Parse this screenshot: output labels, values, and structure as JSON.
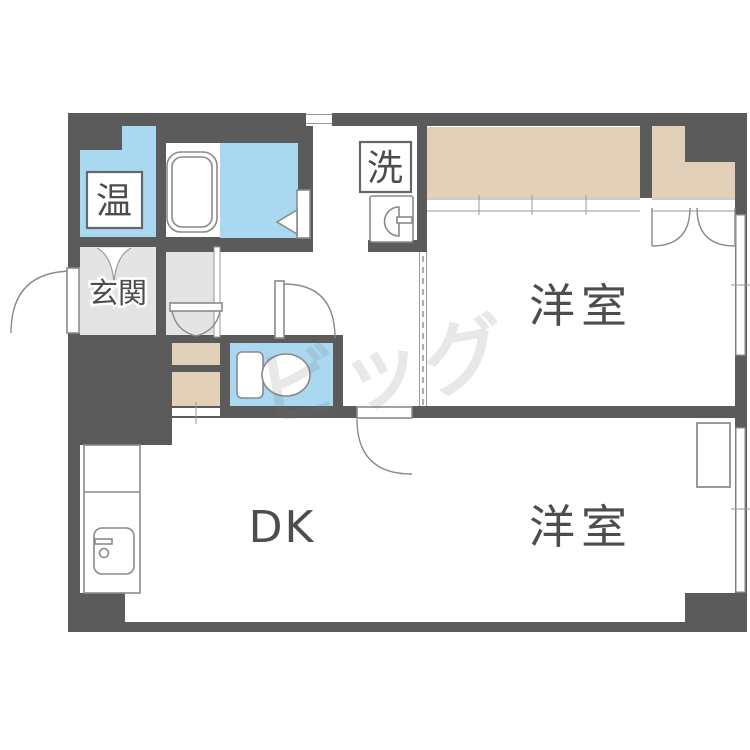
{
  "watermark": "ビッグ",
  "colors": {
    "wall": "#5b5b5b",
    "wet": "#a9d8f0",
    "closet": "#e2d0b8",
    "genkan": "#e4e4e4",
    "line": "#8a8a8a",
    "label": "#4d4d4d"
  },
  "rooms": {
    "water_heater": {
      "label": "温"
    },
    "entrance": {
      "label": "玄関"
    },
    "laundry": {
      "label": "洗"
    },
    "western_room_top": {
      "label": "洋室"
    },
    "western_room_bottom": {
      "label": "洋室"
    },
    "dining_kitchen": {
      "label": "DK"
    }
  }
}
